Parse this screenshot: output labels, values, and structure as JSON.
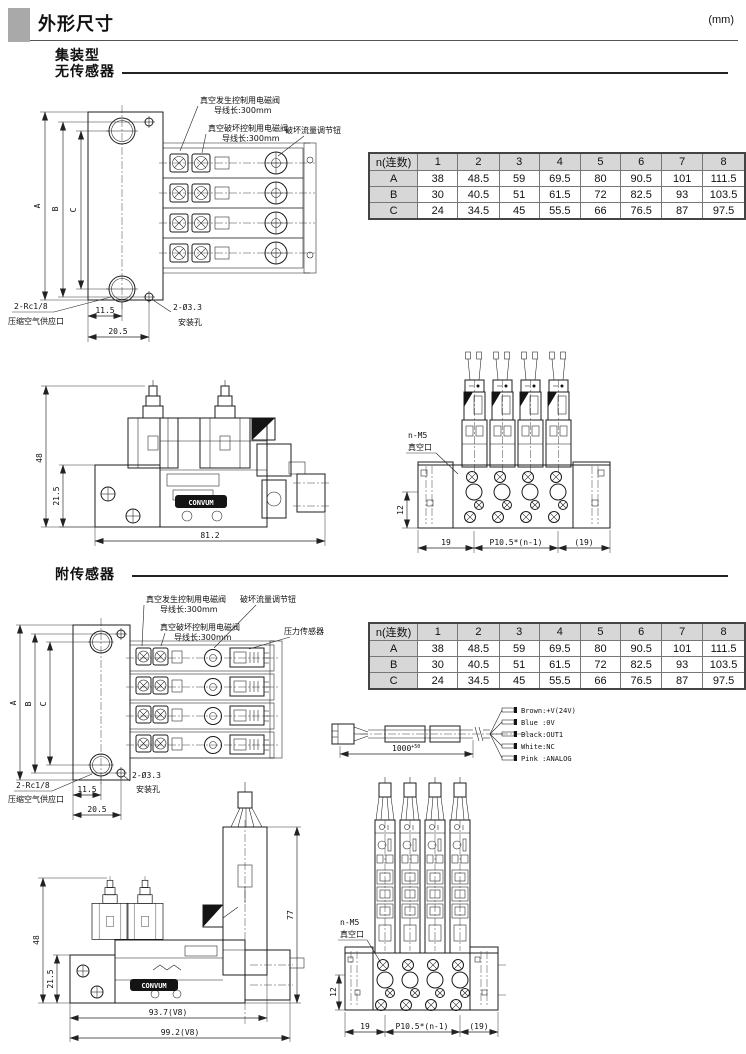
{
  "page": {
    "title": "外形尺寸",
    "unit": "(mm)"
  },
  "s1": {
    "line1": "集装型",
    "line2": "无传感器",
    "plan": {
      "gen_valve": "真空发生控制用电磁阀",
      "gen_lead": "导线长:300mm",
      "brk_valve": "真空破坏控制用电磁阀",
      "brk_lead": "导线长:300mm",
      "knob": "破坏流量调节钮",
      "dimA": "A",
      "dimB": "B",
      "dimC": "C",
      "port": "2-Rc1/8",
      "port_sub": "压缩空气供应口",
      "d115": "11.5",
      "d205": "20.5",
      "hole": "2-Ø3.3",
      "hole_sub": "安装孔"
    },
    "table": {
      "header": [
        "n(连数)",
        "1",
        "2",
        "3",
        "4",
        "5",
        "6",
        "7",
        "8"
      ],
      "rows": [
        {
          "label": "A",
          "v": [
            "38",
            "48.5",
            "59",
            "69.5",
            "80",
            "90.5",
            "101",
            "111.5"
          ]
        },
        {
          "label": "B",
          "v": [
            "30",
            "40.5",
            "51",
            "61.5",
            "72",
            "82.5",
            "93",
            "103.5"
          ]
        },
        {
          "label": "C",
          "v": [
            "24",
            "34.5",
            "45",
            "55.5",
            "66",
            "76.5",
            "87",
            "97.5"
          ]
        }
      ]
    },
    "side": {
      "d48": "48",
      "d215": "21.5",
      "d812": "81.2",
      "logo": "CONVUM"
    },
    "front": {
      "vac": "n-M5",
      "vac_sub": "真空口",
      "d12": "12",
      "d19": "19",
      "pitch": "P10.5*(n-1)",
      "d19p": "(19)"
    }
  },
  "s2": {
    "heading": "附传感器",
    "plan": {
      "gen_valve": "真空发生控制用电磁阀",
      "gen_lead": "导线长:300mm",
      "brk_valve": "真空破坏控制用电磁阀",
      "brk_lead": "导线长:300mm",
      "knob": "破坏流量调节钮",
      "sensor": "压力传感器",
      "dimA": "A",
      "dimB": "B",
      "dimC": "C",
      "port": "2-Rc1/8",
      "port_sub": "压缩空气供应口",
      "d115": "11.5",
      "d205": "20.5",
      "hole": "2-Ø3.3",
      "hole_sub": "安装孔"
    },
    "table": {
      "header": [
        "n(连数)",
        "1",
        "2",
        "3",
        "4",
        "5",
        "6",
        "7",
        "8"
      ],
      "rows": [
        {
          "label": "A",
          "v": [
            "38",
            "48.5",
            "59",
            "69.5",
            "80",
            "90.5",
            "101",
            "111.5"
          ]
        },
        {
          "label": "B",
          "v": [
            "30",
            "40.5",
            "51",
            "61.5",
            "72",
            "82.5",
            "93",
            "103.5"
          ]
        },
        {
          "label": "C",
          "v": [
            "24",
            "34.5",
            "45",
            "55.5",
            "66",
            "76.5",
            "87",
            "97.5"
          ]
        }
      ]
    },
    "cable": {
      "len": "1000",
      "tol": "+50",
      "wires": [
        "Brown:+V(24V)",
        "Blue :0V",
        "Black:OUT1",
        "White:NC",
        "Pink :ANALOG"
      ]
    },
    "side": {
      "d48": "48",
      "d215": "21.5",
      "d77": "77",
      "d937": "93.7(V8)",
      "d992": "99.2(V8)",
      "logo": "CONVUM"
    },
    "front": {
      "vac": "n-M5",
      "vac_sub": "真空口",
      "d12": "12",
      "d19": "19",
      "pitch": "P10.5*(n-1)",
      "d19p": "(19)"
    }
  }
}
